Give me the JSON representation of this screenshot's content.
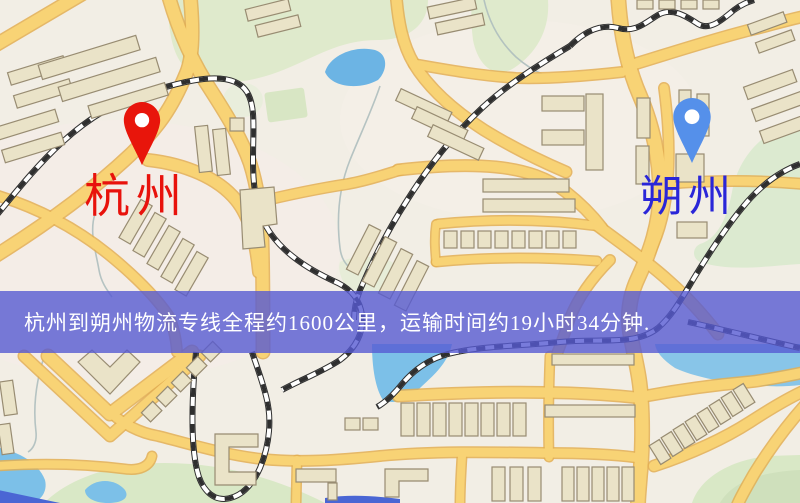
{
  "page": {
    "type": "logistics-route-map-graphic"
  },
  "markers": {
    "origin": {
      "label": "杭州",
      "pin_color": "#e8150b",
      "label_color": "#e8120c"
    },
    "destination": {
      "label": "朔州",
      "pin_color": "#5590ea",
      "label_color": "#2a26d8"
    }
  },
  "banner": {
    "text": "杭州到朔州物流专线全程约1600公里，运输时间约19小时34分钟.",
    "background_color": "#585cd2",
    "text_color": "#ffffff"
  },
  "route": {
    "origin": "杭州",
    "destination": "朔州",
    "distance": "约1600公里",
    "duration": "约19小时34分钟"
  },
  "map_colors": {
    "background": "#f2eee5",
    "road_yellow": "#f8d375",
    "road_casing": "#e3ae52",
    "building": "#eae3c8",
    "park_green": "#dfeacc",
    "water_blue": "#7cc0e8",
    "railway": "#2f2f2f"
  }
}
